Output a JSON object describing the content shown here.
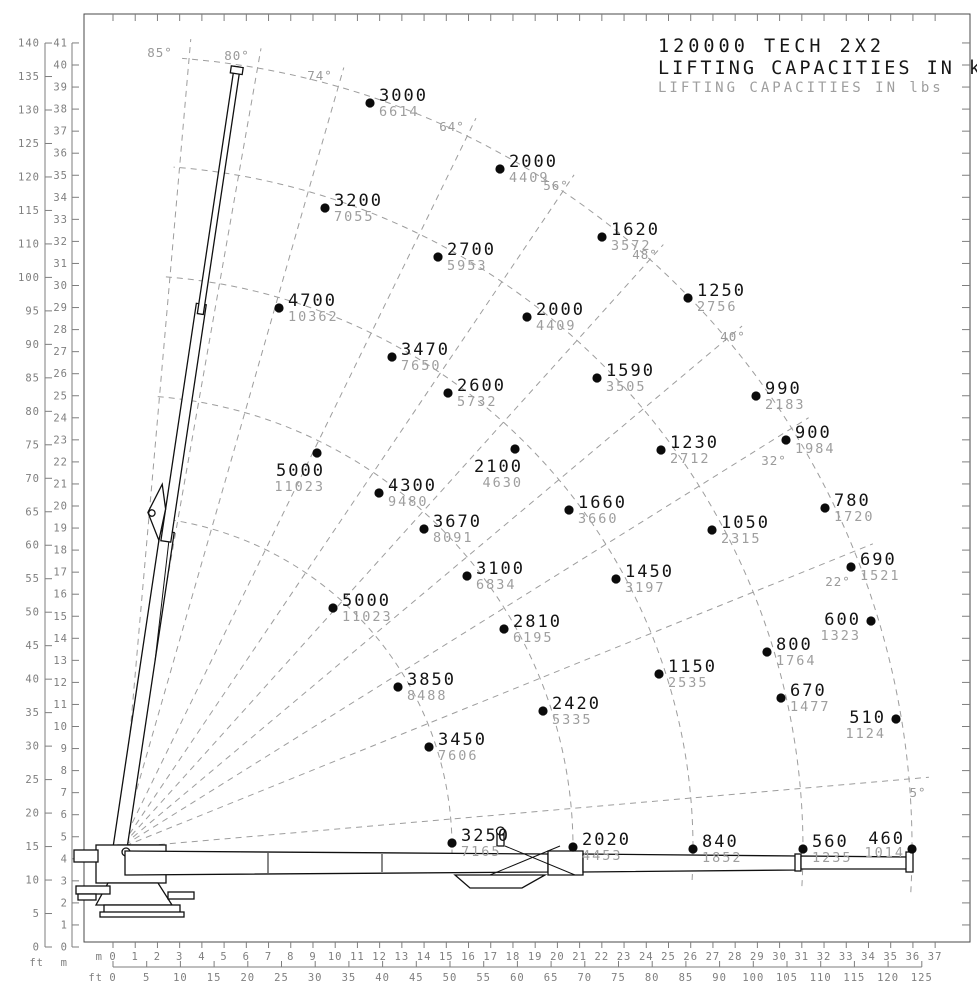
{
  "title": {
    "line1": "120000 TECH 2X2",
    "line2": "LIFTING CAPACITIES IN kg",
    "line3": "LIFTING CAPACITIES IN lbs"
  },
  "colors": {
    "foreground": "#141414",
    "muted_gray": "#9e9e9e",
    "axis_gray": "#7e7e7e",
    "dash_gray": "#9d9d9d"
  },
  "chart_data": {
    "type": "scatter",
    "title": "120000 TECH 2X2",
    "subtitle_kg": "LIFTING CAPACITIES IN kg",
    "subtitle_lbs": "LIFTING CAPACITIES IN lbs",
    "units_primary": "kg",
    "units_secondary": "lbs",
    "grid": "polar-dashed",
    "y_axis": {
      "m_label": "m",
      "ft_label": "ft",
      "m_ticks": [
        0,
        1,
        2,
        3,
        4,
        5,
        6,
        7,
        8,
        9,
        10,
        11,
        12,
        13,
        14,
        15,
        16,
        17,
        18,
        19,
        20,
        21,
        22,
        23,
        24,
        25,
        26,
        27,
        28,
        29,
        30,
        31,
        32,
        33,
        34,
        35,
        36,
        37,
        38,
        39,
        40,
        41
      ],
      "ft_ticks": [
        0,
        5,
        10,
        15,
        20,
        25,
        30,
        35,
        40,
        45,
        50,
        55,
        60,
        65,
        70,
        75,
        80,
        85,
        90,
        95,
        100,
        110,
        115,
        120,
        125,
        130,
        135,
        140
      ]
    },
    "x_axis": {
      "m_label": "m",
      "ft_label": "ft",
      "m_ticks": [
        0,
        1,
        2,
        3,
        4,
        5,
        6,
        7,
        8,
        9,
        10,
        11,
        12,
        13,
        14,
        15,
        16,
        17,
        18,
        19,
        20,
        21,
        22,
        23,
        24,
        25,
        26,
        27,
        28,
        29,
        30,
        31,
        32,
        33,
        34,
        35,
        36,
        37
      ],
      "ft_ticks": [
        0,
        5,
        10,
        15,
        20,
        25,
        30,
        35,
        40,
        45,
        50,
        55,
        60,
        65,
        70,
        75,
        80,
        85,
        90,
        100,
        105,
        110,
        115,
        120,
        125
      ]
    },
    "layout": {
      "frame": {
        "x1": 84,
        "y1": 14,
        "x2": 970,
        "y2": 942
      },
      "x_m0_px": 113,
      "x_px_per_m": 22.22,
      "y_m0_px": 947,
      "y_px_per_m": 22.05,
      "left_ft_line_x": 45,
      "left_ft_slot_px": 33.48,
      "left_m_line_x": 72,
      "bottom_m_label_y": 960,
      "bottom_ft_line_y": 967,
      "bottom_ft_slot_px": 33.7,
      "bottom_ft_label_y": 981,
      "origin_px": {
        "x": 120,
        "y": 848
      },
      "arc_radii_px": [
        332,
        453,
        573,
        683,
        792
      ],
      "arc_angle_start_deg": -3.2,
      "arc_angle_end_deg": 85.5,
      "radial_inner_px": 6,
      "radial_outer_px": 812
    },
    "angle_lines": [
      {
        "deg": 85,
        "label": "85°",
        "lx": 160,
        "ly": 57
      },
      {
        "deg": 80,
        "label": "80°",
        "lx": 237,
        "ly": 60
      },
      {
        "deg": 74,
        "label": "74°",
        "lx": 320,
        "ly": 80
      },
      {
        "deg": 64,
        "label": "64°",
        "lx": 452,
        "ly": 131
      },
      {
        "deg": 56,
        "label": "56°",
        "lx": 556,
        "ly": 190
      },
      {
        "deg": 48,
        "label": "48°",
        "lx": 645,
        "ly": 259
      },
      {
        "deg": 40,
        "label": "40°",
        "lx": 733,
        "ly": 341
      },
      {
        "deg": 32,
        "label": "32°",
        "lx": 774,
        "ly": 465
      },
      {
        "deg": 22,
        "label": "22°",
        "lx": 838,
        "ly": 586
      },
      {
        "deg": 5,
        "label": "5°",
        "lx": 918,
        "ly": 797
      }
    ],
    "points": [
      {
        "kg": "3000",
        "lbs": "6614",
        "x": 370,
        "y": 103,
        "side": "r"
      },
      {
        "kg": "2000",
        "lbs": "4409",
        "x": 500,
        "y": 169,
        "side": "r"
      },
      {
        "kg": "3200",
        "lbs": "7055",
        "x": 325,
        "y": 208,
        "side": "r"
      },
      {
        "kg": "1620",
        "lbs": "3572",
        "x": 602,
        "y": 237,
        "side": "r"
      },
      {
        "kg": "2700",
        "lbs": "5953",
        "x": 438,
        "y": 257,
        "side": "r"
      },
      {
        "kg": "4700",
        "lbs": "10362",
        "x": 279,
        "y": 308,
        "side": "r"
      },
      {
        "kg": "2000",
        "lbs": "4409",
        "x": 527,
        "y": 317,
        "side": "r"
      },
      {
        "kg": "1250",
        "lbs": "2756",
        "x": 688,
        "y": 298,
        "side": "r"
      },
      {
        "kg": "3470",
        "lbs": "7650",
        "x": 392,
        "y": 357,
        "side": "r"
      },
      {
        "kg": "1590",
        "lbs": "3505",
        "x": 597,
        "y": 378,
        "side": "r"
      },
      {
        "kg": "990",
        "lbs": "2183",
        "x": 756,
        "y": 396,
        "side": "r"
      },
      {
        "kg": "2600",
        "lbs": "5732",
        "x": 448,
        "y": 393,
        "side": "r"
      },
      {
        "kg": "900",
        "lbs": "1984",
        "x": 786,
        "y": 440,
        "side": "r"
      },
      {
        "kg": "1230",
        "lbs": "2712",
        "x": 661,
        "y": 450,
        "side": "r"
      },
      {
        "kg": "5000",
        "lbs": "11023",
        "x": 317,
        "y": 453,
        "side": "bl"
      },
      {
        "kg": "2100",
        "lbs": "4630",
        "x": 515,
        "y": 449,
        "side": "bl"
      },
      {
        "kg": "4300",
        "lbs": "9480",
        "x": 379,
        "y": 493,
        "side": "r"
      },
      {
        "kg": "1660",
        "lbs": "3660",
        "x": 569,
        "y": 510,
        "side": "r"
      },
      {
        "kg": "1050",
        "lbs": "2315",
        "x": 712,
        "y": 530,
        "side": "r"
      },
      {
        "kg": "780",
        "lbs": "1720",
        "x": 825,
        "y": 508,
        "side": "r"
      },
      {
        "kg": "3670",
        "lbs": "8091",
        "x": 424,
        "y": 529,
        "side": "r"
      },
      {
        "kg": "690",
        "lbs": "1521",
        "x": 851,
        "y": 567,
        "side": "r"
      },
      {
        "kg": "3100",
        "lbs": "6834",
        "x": 467,
        "y": 576,
        "side": "r"
      },
      {
        "kg": "1450",
        "lbs": "3197",
        "x": 616,
        "y": 579,
        "side": "r"
      },
      {
        "kg": "5000",
        "lbs": "11023",
        "x": 333,
        "y": 608,
        "side": "r"
      },
      {
        "kg": "2810",
        "lbs": "6195",
        "x": 504,
        "y": 629,
        "side": "r"
      },
      {
        "kg": "600",
        "lbs": "1323",
        "x": 871,
        "y": 621,
        "side": "l"
      },
      {
        "kg": "800",
        "lbs": "1764",
        "x": 767,
        "y": 652,
        "side": "r"
      },
      {
        "kg": "1150",
        "lbs": "2535",
        "x": 659,
        "y": 674,
        "side": "r"
      },
      {
        "kg": "670",
        "lbs": "1477",
        "x": 781,
        "y": 698,
        "side": "r"
      },
      {
        "kg": "3850",
        "lbs": "8488",
        "x": 398,
        "y": 687,
        "side": "r"
      },
      {
        "kg": "510",
        "lbs": "1124",
        "x": 896,
        "y": 719,
        "side": "l"
      },
      {
        "kg": "2420",
        "lbs": "5335",
        "x": 543,
        "y": 711,
        "side": "r"
      },
      {
        "kg": "3450",
        "lbs": "7606",
        "x": 429,
        "y": 747,
        "side": "r"
      },
      {
        "kg": "3250",
        "lbs": "7165",
        "x": 452,
        "y": 843,
        "side": "r"
      },
      {
        "kg": "2020",
        "lbs": "4453",
        "x": 573,
        "y": 847,
        "side": "r"
      },
      {
        "kg": "840",
        "lbs": "1852",
        "x": 693,
        "y": 849,
        "side": "r"
      },
      {
        "kg": "560",
        "lbs": "1235",
        "x": 803,
        "y": 849,
        "side": "r"
      },
      {
        "kg": "460",
        "lbs": "1014",
        "x": 912,
        "y": 849,
        "side": "lu"
      }
    ]
  }
}
